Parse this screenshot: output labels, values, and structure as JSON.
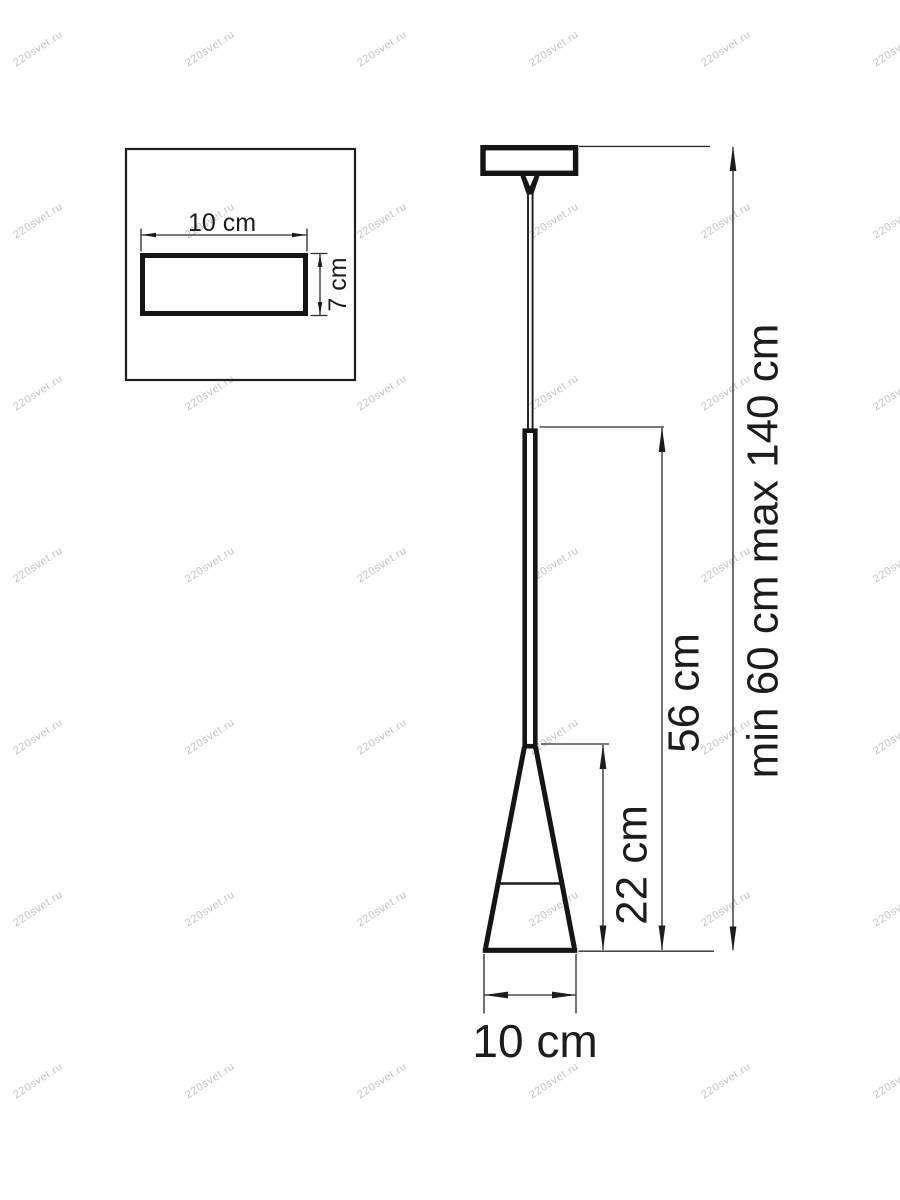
{
  "image": {
    "background_color": "#ffffff",
    "line_color": "#1c1c1c"
  },
  "watermark": {
    "text": "220svet.ru",
    "color": "#c3c3c3",
    "font_size_px": 11,
    "rotation_deg": -33,
    "grid_x": [
      38,
      210,
      382,
      554,
      726,
      898
    ],
    "grid_y": [
      49,
      221,
      393,
      565,
      737,
      909,
      1081
    ]
  },
  "canopy_inset": {
    "width_label": "10 cm",
    "height_label": "7 cm"
  },
  "pendant": {
    "suspension_range_label": "min 60 cm  max 140 cm",
    "fixture_height_label": "56 cm",
    "shade_height_label": "22 cm",
    "shade_diameter_label": "10 cm"
  }
}
